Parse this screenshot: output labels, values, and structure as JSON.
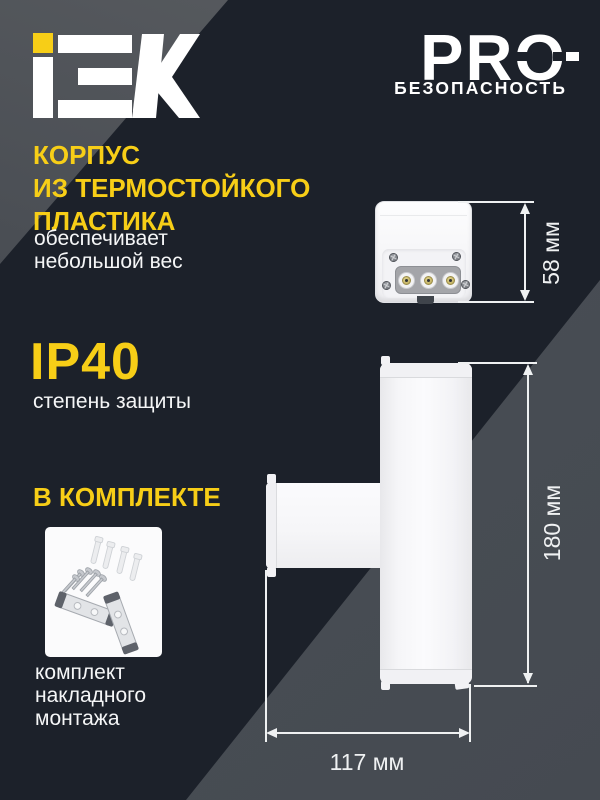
{
  "header": {
    "logo": "IEK",
    "pro": "PRO",
    "pro_sub": "БЕЗОПАСНОСТЬ"
  },
  "feature_plastic": {
    "title_line1": "КОРПУС",
    "title_line2": "ИЗ ТЕРМОСТОЙКОГО",
    "title_line3": "ПЛАСТИКА",
    "desc_line1": "обеспечивает",
    "desc_line2": "небольшой вес"
  },
  "feature_ip": {
    "title": "IP40",
    "desc": "степень защиты"
  },
  "feature_kit": {
    "title": "В КОМПЛЕКТЕ",
    "desc_line1": "комплект",
    "desc_line2": "накладного",
    "desc_line3": "монтажа"
  },
  "dimensions": {
    "box_height": "58 мм",
    "body_height": "180 мм",
    "body_width": "117 мм"
  },
  "colors": {
    "accent_yellow": "#F7CE17",
    "background_dark": "#1C212A",
    "band_gray": "#4A4F56",
    "dimension_line": "#EFF1F2"
  }
}
